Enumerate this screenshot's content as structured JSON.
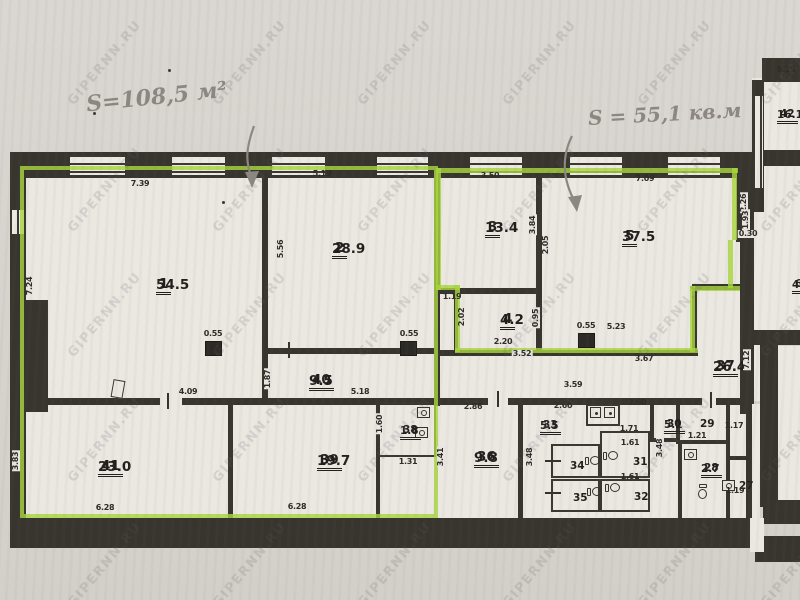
{
  "annotations": {
    "left_area_text": "S=108,5 м²",
    "right_area_text": "S = 55,1 кв.м"
  },
  "watermark_text": "GIPERNN.RU",
  "plan": {
    "rooms": [
      {
        "num": "1",
        "area": "54.5",
        "x": 156,
        "y": 276,
        "lg": 1
      },
      {
        "num": "2",
        "area": "28.9",
        "x": 332,
        "y": 240,
        "lg": 1
      },
      {
        "num": "3",
        "area": "13.4",
        "x": 485,
        "y": 219,
        "lg": 1
      },
      {
        "num": "4",
        "area": "4.2",
        "x": 500,
        "y": 311,
        "lg": 1
      },
      {
        "num": "5",
        "area": "37.5",
        "x": 622,
        "y": 228,
        "lg": 1
      },
      {
        "num": "40",
        "area": "9.5",
        "x": 309,
        "y": 372,
        "lg": 1
      },
      {
        "num": "41",
        "area": "23.0",
        "x": 98,
        "y": 458,
        "lg": 1
      },
      {
        "num": "39",
        "area": "19.7",
        "x": 317,
        "y": 452,
        "lg": 1
      },
      {
        "num": "38",
        "area": "1.8",
        "x": 400,
        "y": 424
      },
      {
        "num": "36",
        "area": "9.8",
        "x": 474,
        "y": 449,
        "lg": 1
      },
      {
        "num": "33",
        "area": "5.5",
        "x": 540,
        "y": 419
      },
      {
        "num": "34",
        "x": 570,
        "y": 460
      },
      {
        "num": "35",
        "x": 573,
        "y": 492
      },
      {
        "num": "31",
        "x": 633,
        "y": 456
      },
      {
        "num": "32",
        "x": 634,
        "y": 491
      },
      {
        "num": "30",
        "area": "5.1",
        "x": 664,
        "y": 418
      },
      {
        "num": "29",
        "x": 700,
        "y": 418
      },
      {
        "num": "28",
        "area": "2.7",
        "x": 701,
        "y": 462
      },
      {
        "num": "27",
        "x": 739,
        "y": 480
      },
      {
        "num": "37",
        "area": "26.4",
        "x": 713,
        "y": 358,
        "lg": 1
      },
      {
        "num": "42",
        "area": "16.1",
        "x": 777,
        "y": 108
      },
      {
        "num": "6",
        "area": "40.",
        "x": 792,
        "y": 278
      }
    ],
    "dims": [
      {
        "t": "7.39",
        "x": 140,
        "y": 184
      },
      {
        "t": "5.19",
        "x": 322,
        "y": 174
      },
      {
        "t": "3.50",
        "x": 490,
        "y": 176
      },
      {
        "t": "7.09",
        "x": 645,
        "y": 179
      },
      {
        "t": "5.15",
        "x": 786,
        "y": 70
      },
      {
        "t": "7.24",
        "x": 30,
        "y": 286,
        "v": 1
      },
      {
        "t": "5.56",
        "x": 281,
        "y": 249,
        "v": 1
      },
      {
        "t": "0.55",
        "x": 213,
        "y": 334
      },
      {
        "t": "0.55",
        "x": 409,
        "y": 334
      },
      {
        "t": "0.55",
        "x": 586,
        "y": 326
      },
      {
        "t": "1.19",
        "x": 452,
        "y": 297
      },
      {
        "t": "2.02",
        "x": 462,
        "y": 317,
        "v": 1
      },
      {
        "t": "2.20",
        "x": 503,
        "y": 342
      },
      {
        "t": "0.95",
        "x": 536,
        "y": 318,
        "v": 1,
        "c": 1
      },
      {
        "t": "3.84",
        "x": 533,
        "y": 225,
        "v": 1,
        "c": 1
      },
      {
        "t": "2.05",
        "x": 546,
        "y": 245,
        "v": 1,
        "c": 1
      },
      {
        "t": "5.23",
        "x": 616,
        "y": 327
      },
      {
        "t": "3.52",
        "x": 522,
        "y": 354,
        "c": 1
      },
      {
        "t": "3.67",
        "x": 644,
        "y": 359
      },
      {
        "t": "3.59",
        "x": 573,
        "y": 385
      },
      {
        "t": "1.87",
        "x": 268,
        "y": 379,
        "v": 1,
        "c": 1
      },
      {
        "t": "5.18",
        "x": 360,
        "y": 392
      },
      {
        "t": "4.09",
        "x": 188,
        "y": 392
      },
      {
        "t": "6.28",
        "x": 105,
        "y": 508
      },
      {
        "t": "6.28",
        "x": 297,
        "y": 507
      },
      {
        "t": "3.83",
        "x": 16,
        "y": 461,
        "v": 1,
        "c": 1
      },
      {
        "t": "1.60",
        "x": 380,
        "y": 424,
        "v": 1,
        "c": 1
      },
      {
        "t": "1.31",
        "x": 408,
        "y": 462
      },
      {
        "t": "3.41",
        "x": 441,
        "y": 457,
        "v": 1,
        "c": 1
      },
      {
        "t": "2.86",
        "x": 473,
        "y": 407
      },
      {
        "t": "2.60",
        "x": 563,
        "y": 406
      },
      {
        "t": "2.60",
        "x": 637,
        "y": 403
      },
      {
        "t": "3.48",
        "x": 530,
        "y": 457,
        "v": 1,
        "c": 1
      },
      {
        "t": "1.71",
        "x": 629,
        "y": 429
      },
      {
        "t": "1.61",
        "x": 630,
        "y": 443
      },
      {
        "t": "1.61",
        "x": 630,
        "y": 477
      },
      {
        "t": "3.48",
        "x": 660,
        "y": 448,
        "v": 1,
        "c": 1
      },
      {
        "t": "1.21",
        "x": 697,
        "y": 436
      },
      {
        "t": "1.17",
        "x": 734,
        "y": 426
      },
      {
        "t": "1.19",
        "x": 735,
        "y": 491
      },
      {
        "t": "7.12",
        "x": 747,
        "y": 360,
        "v": 1,
        "c": 1
      },
      {
        "t": "2.26",
        "x": 744,
        "y": 203,
        "v": 1,
        "c": 1
      },
      {
        "t": "1.93",
        "x": 746,
        "y": 220,
        "v": 1,
        "c": 1
      },
      {
        "t": "0.30",
        "x": 748,
        "y": 234,
        "c": 1
      }
    ],
    "vent_shafts": [
      {
        "x": 205,
        "y": 341
      },
      {
        "x": 400,
        "y": 341
      },
      {
        "x": 578,
        "y": 333
      }
    ],
    "fixtures": [
      {
        "k": "basin",
        "x": 417,
        "y": 407
      },
      {
        "k": "basin",
        "x": 415,
        "y": 427
      },
      {
        "k": "vent2",
        "x": 590,
        "y": 407
      },
      {
        "k": "vent2",
        "x": 604,
        "y": 407
      },
      {
        "k": "wc",
        "x": 585,
        "y": 455
      },
      {
        "k": "wc",
        "x": 587,
        "y": 486
      },
      {
        "k": "wc",
        "x": 603,
        "y": 450
      },
      {
        "k": "wc",
        "x": 605,
        "y": 482
      },
      {
        "k": "basin",
        "x": 684,
        "y": 449
      },
      {
        "k": "wcv",
        "x": 697,
        "y": 484
      },
      {
        "k": "basin",
        "x": 722,
        "y": 480
      }
    ],
    "ticks": [
      {
        "x": 167,
        "y": 393,
        "o": "v"
      },
      {
        "x": 497,
        "y": 391,
        "o": "v"
      },
      {
        "x": 288,
        "y": 342,
        "o": "v"
      },
      {
        "x": 710,
        "y": 392,
        "o": "v"
      },
      {
        "x": 545,
        "y": 460,
        "o": "h"
      },
      {
        "x": 545,
        "y": 492,
        "o": "h"
      },
      {
        "x": 733,
        "y": 458,
        "o": "h"
      }
    ],
    "specks": [
      {
        "x": 222,
        "y": 201
      },
      {
        "x": 168,
        "y": 69
      },
      {
        "x": 93,
        "y": 112
      }
    ]
  }
}
